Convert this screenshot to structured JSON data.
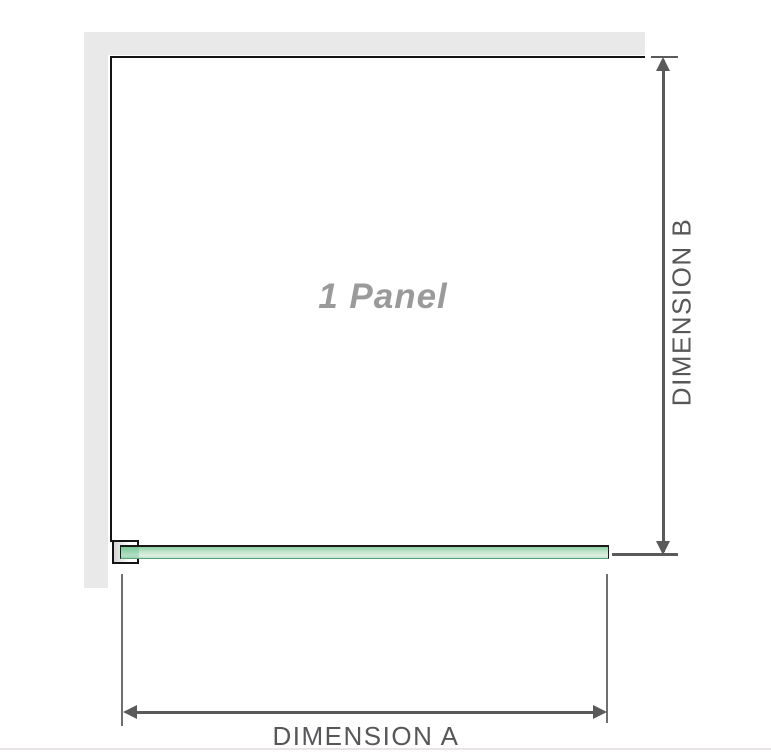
{
  "figure": {
    "panel_label": "1 Panel",
    "dimension_a": {
      "label": "DIMENSION A"
    },
    "dimension_b": {
      "label": "DIMENSION B"
    }
  },
  "colors": {
    "wall_fill": "#e9e9e9",
    "panel_outline": "#141414",
    "dimension_line": "#5a5a5a",
    "dimension_text": "#57575a",
    "panel_label_text": "#9a9a9a",
    "glass_green_top": "#8ccfa2",
    "glass_green_light": "#def0e3",
    "glass_bottom_edge": "#5f9f7c",
    "bottom_rule": "#e8e5e4"
  },
  "icons": {
    "arrow_up": "css-triangle-up",
    "arrow_down": "css-triangle-down",
    "arrow_left": "css-triangle-left",
    "arrow_right": "css-triangle-right"
  }
}
